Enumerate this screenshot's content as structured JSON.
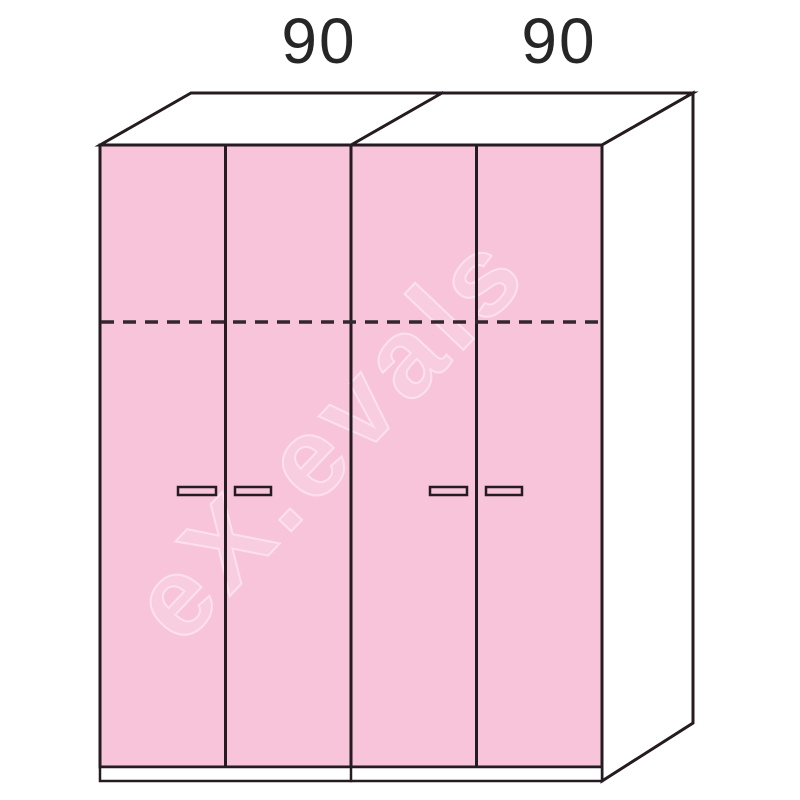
{
  "diagram": {
    "kind": "wardrobe-technical-drawing",
    "units": [
      {
        "width_label": "90",
        "doors": 2
      },
      {
        "width_label": "90",
        "doors": 2
      }
    ]
  },
  "dimensions": {
    "left_label": "90",
    "right_label": "90"
  },
  "watermark": {
    "text": "eX.evals"
  },
  "colors": {
    "door_fill": "#F8C4DA",
    "handle_fill": "#F8C4DA",
    "outline": "#241C20",
    "dashed_line": "#33262E",
    "panel_fill": "#FFFFFF",
    "background": "#FFFFFF",
    "dimension_text": "#262626",
    "watermark": "#FFFFFF"
  }
}
